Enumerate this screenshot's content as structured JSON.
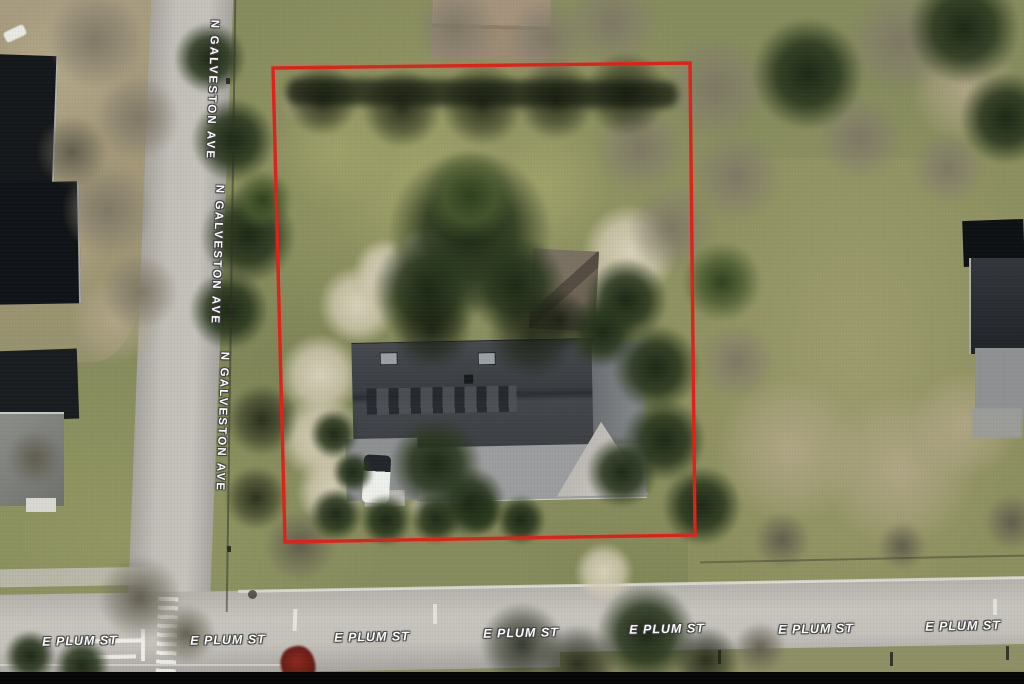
{
  "map_type": "satellite-aerial",
  "boundary": {
    "points": "273,68 690,63 695,535 285,542",
    "color": "#e3201a",
    "stroke_width": "3.4",
    "label": "property-boundary"
  },
  "streets": {
    "galveston": {
      "name": "N GALVESTON AVE",
      "orientation": "vertical",
      "label_count": 3
    },
    "plum": {
      "name": "E PLUM ST",
      "orientation": "horizontal",
      "label_count": 7
    }
  },
  "label_style": {
    "text_color": "#ffffff",
    "outline_color": "#404040"
  }
}
